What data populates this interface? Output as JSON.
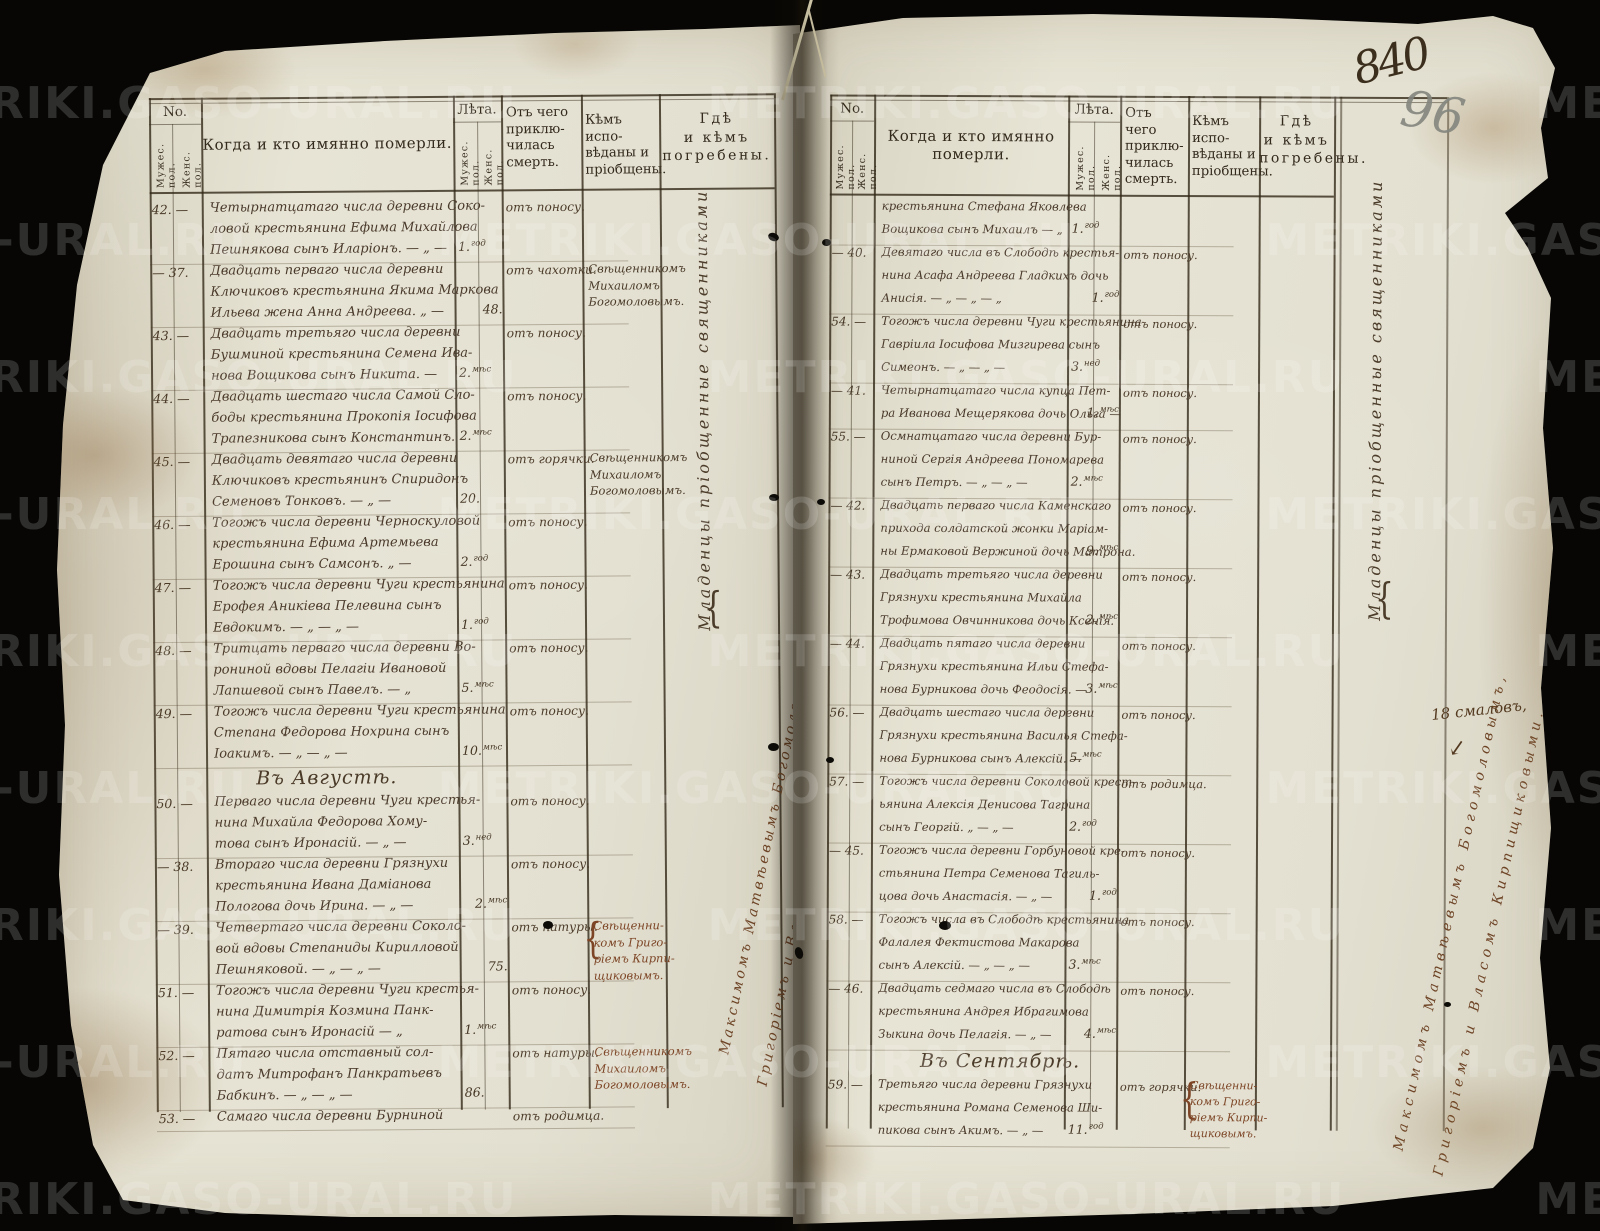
{
  "watermark": "METRIKI.GASO-URAL.RU",
  "annotations": {
    "folio_number_ink": "840",
    "folio_number_pencil": "96",
    "margin_note": "18 смаловъ,",
    "margin_arrow": "↙"
  },
  "column_headers": {
    "no": "No.",
    "age": "Лѣта.",
    "male": "Мужес. пол.",
    "female": "Женс. пол.",
    "when_who": "Когда и кто имянно померли.",
    "cause_lines": [
      "Отъ чего",
      "приклю-",
      "чилась",
      "смерть."
    ],
    "confessed_lines": [
      "Кѣмъ испо-",
      "вѣданы и",
      "пріобщены."
    ],
    "buried_lines": [
      "Гдѣ",
      "и кѣмъ",
      "погребены."
    ]
  },
  "left_page": {
    "entries": [
      {
        "no": "42.",
        "gender": "m",
        "lines": [
          "Четырнатцатаго числа деревни Соко-",
          "ловой крестьянина Ефима Михайлова",
          "Пешнякова сынъ Иларіонъ. — „ —"
        ],
        "age_value": "1.",
        "age_unit": "год",
        "cause": "отъ поносу."
      },
      {
        "no": "37.",
        "gender": "f",
        "lines": [
          "Двадцать перваго числа деревни",
          "Ключиковъ крестьянина Якима Маркова",
          "Ильева жена Анна Андреева. „ —"
        ],
        "age_value": "48.",
        "age_unit": "",
        "cause": "отъ чахотки.",
        "confessor_lines": [
          "Свѣщенникомъ",
          "Михаиломъ",
          "Богомоловымъ."
        ],
        "confessor_ink": "dark"
      },
      {
        "no": "43.",
        "gender": "m",
        "lines": [
          "Двадцать третьяго числа деревни",
          "Бушминой крестьянина Семена Ива-",
          "нова Вощикова сынъ Никита. —"
        ],
        "age_value": "2.",
        "age_unit": "мѣс",
        "cause": "отъ поносу."
      },
      {
        "no": "44.",
        "gender": "m",
        "lines": [
          "Двадцать шестаго числа Самой Сло-",
          "боды крестьянина Прокопія Іосифова",
          "Трапезникова сынъ Константинъ."
        ],
        "age_value": "2.",
        "age_unit": "мѣс",
        "cause": "отъ поносу."
      },
      {
        "no": "45.",
        "gender": "m",
        "lines": [
          "Двадцать девятаго числа деревни",
          "Ключиковъ крестьянинъ Спиридонъ",
          "Семеновъ Тонковъ. — „ —"
        ],
        "age_value": "20.",
        "age_unit": "",
        "cause": "отъ горячки.",
        "confessor_lines": [
          "Свѣщенникомъ",
          "Михаиломъ",
          "Богомоловымъ."
        ],
        "confessor_ink": "dark"
      },
      {
        "no": "46.",
        "gender": "m",
        "lines": [
          "Тогожъ числа деревни Черноскуловой",
          "крестьянина Ефима Артемьева",
          "Ерошина сынъ Самсонъ. „ —"
        ],
        "age_value": "2.",
        "age_unit": "год",
        "cause": "отъ поносу."
      },
      {
        "no": "47.",
        "gender": "m",
        "lines": [
          "Тогожъ числа деревни Чуги крестьянина",
          "Ерофея Аникіева Пелевина сынъ",
          "Евдокимъ. — „ — „ —"
        ],
        "age_value": "1.",
        "age_unit": "год",
        "cause": "отъ поносу."
      },
      {
        "no": "48.",
        "gender": "m",
        "lines": [
          "Тритцать перваго числа деревни Во-",
          "рониной вдовы Пелагіи Ивановой",
          "Лапшевой сынъ Павелъ. — „"
        ],
        "age_value": "5.",
        "age_unit": "мѣс",
        "cause": "отъ поносу."
      },
      {
        "no": "49.",
        "gender": "m",
        "lines": [
          "Тогожъ числа деревни Чуги крестьянина",
          "Степана Федорова Нохрина сынъ",
          "Іоакимъ. — „ — „ —"
        ],
        "age_value": "10.",
        "age_unit": "мѣс",
        "cause": "отъ поносу."
      },
      {
        "month_heading": "Въ Августѣ."
      },
      {
        "no": "50.",
        "gender": "m",
        "lines": [
          "Перваго числа деревни Чуги крестья-",
          "нина Михайла Федорова Хому-",
          "това сынъ Иронасій. — „ —"
        ],
        "age_value": "3.",
        "age_unit": "нед",
        "cause": "отъ поносу."
      },
      {
        "no": "38.",
        "gender": "f",
        "lines": [
          "Втораго числа деревни Грязнухи",
          "крестьянина Ивана Даміанова",
          "Пологова дочь Ирина. — „ —"
        ],
        "age_value": "2.",
        "age_unit": "мѣс",
        "cause": "отъ поносу."
      },
      {
        "no": "39.",
        "gender": "f",
        "lines": [
          "Четвертаго числа деревни Соколо-",
          "вой вдовы Степаниды Кирилловой",
          "Пешняковой. — „ — „ —"
        ],
        "age_value": "75.",
        "age_unit": "",
        "cause": "отъ натуры.",
        "confessor_lines": [
          "Свѣщенни-",
          "комъ Григо-",
          "ріемъ Кирпи-",
          "щиковымъ."
        ],
        "confessor_ink": "red",
        "brace": true
      },
      {
        "no": "51.",
        "gender": "m",
        "lines": [
          "Тогожъ числа деревни Чуги крестья-",
          "нина Димитрія Козмина Панк-",
          "ратова сынъ Иронасій — „"
        ],
        "age_value": "1.",
        "age_unit": "мѣс",
        "cause": "отъ поносу."
      },
      {
        "no": "52.",
        "gender": "m",
        "lines": [
          "Пятаго числа отставный сол-",
          "датъ Митрофанъ Панкратьевъ",
          "Бабкинъ. — „ — „ —"
        ],
        "age_value": "86.",
        "age_unit": "",
        "cause": "отъ натуры.",
        "confessor_lines": [
          "Свѣщенникомъ",
          "Михаиломъ",
          "Богомоловымъ."
        ],
        "confessor_ink": "red"
      },
      {
        "no": "53.",
        "gender": "m",
        "lines": [
          "Самаго числа деревни Бурниной"
        ],
        "cause": "отъ родимца."
      }
    ],
    "vertical_note": {
      "text": "Младенцы пріобщенные священниками",
      "names": [
        "Максимомъ Матвѣевымъ Богомоловымъ,",
        "Григоріемъ и Власомъ Кирпищиковыми."
      ]
    }
  },
  "right_page": {
    "entries": [
      {
        "no": "",
        "gender": "m",
        "lines": [
          "крестьянина Стефана Яковлева",
          "Вощикова сынъ Михаилъ — „"
        ],
        "age_value": "1.",
        "age_unit": "год"
      },
      {
        "no": "40.",
        "gender": "f",
        "lines": [
          "Девятаго числа въ Слободѣ крестья-",
          "нина Асафа Андреева Гладкихъ дочь",
          "Анисія. — „ — „ — „"
        ],
        "age_value": "1.",
        "age_unit": "год",
        "cause": "отъ поносу."
      },
      {
        "no": "54.",
        "gender": "m",
        "lines": [
          "Тогожъ числа деревни Чуги крестьянина",
          "Гавріила Іосифова Мизгирева сынъ",
          "Симеонъ. — „ — „ —"
        ],
        "age_value": "3.",
        "age_unit": "нед",
        "cause": "отъ поносу."
      },
      {
        "no": "41.",
        "gender": "f",
        "lines": [
          "Четырнатцатаго числа купца Пет-",
          "ра Иванова Мещерякова дочь Ольга —"
        ],
        "age_value": "1.",
        "age_unit": "мѣс",
        "cause": "отъ поносу."
      },
      {
        "no": "55.",
        "gender": "m",
        "lines": [
          "Осмнатцатаго числа деревни Бур-",
          "ниной Сергія Андреева Пономарева",
          "сынъ Петръ. — „ — „ —"
        ],
        "age_value": "2.",
        "age_unit": "мѣс",
        "cause": "отъ поносу."
      },
      {
        "no": "42.",
        "gender": "f",
        "lines": [
          "Двадцать перваго числа Каменскаго",
          "прихода солдатской жонки Маріам-",
          "ны Ермаковой Вержиной дочь Матрона."
        ],
        "age_value": "9.",
        "age_unit": "мѣс",
        "cause": "отъ поносу."
      },
      {
        "no": "43.",
        "gender": "f",
        "lines": [
          "Двадцать третьяго числа деревни",
          "Грязнухи крестьянина Михайла",
          "Трофимова Овчинникова дочь Ксенія."
        ],
        "age_value": "2.",
        "age_unit": "мѣс",
        "cause": "отъ поносу."
      },
      {
        "no": "44.",
        "gender": "f",
        "lines": [
          "Двадцать пятаго числа деревни",
          "Грязнухи крестьянина Ильи Стефа-",
          "нова Бурникова дочь Феодосія. —"
        ],
        "age_value": "3.",
        "age_unit": "мѣс",
        "cause": "отъ поносу."
      },
      {
        "no": "56.",
        "gender": "m",
        "lines": [
          "Двадцать шестаго числа деревни",
          "Грязнухи крестьянина Василья Стефа-",
          "нова Бурникова сынъ Алексій. —"
        ],
        "age_value": "5.",
        "age_unit": "мѣс",
        "cause": "отъ поносу."
      },
      {
        "no": "57.",
        "gender": "m",
        "lines": [
          "Тогожъ числа деревни Соколовой крест-",
          "ьянина Алексія Денисова Тагрина",
          "сынъ Георгій. „ — „ —"
        ],
        "age_value": "2.",
        "age_unit": "год",
        "cause": "отъ родимца."
      },
      {
        "no": "45.",
        "gender": "f",
        "lines": [
          "Тогожъ числа деревни Горбуновой кре-",
          "стьянина Петра Семенова Тагиль-",
          "цова дочь Анастасія. — „ —"
        ],
        "age_value": "1.",
        "age_unit": "год",
        "cause": "отъ поносу."
      },
      {
        "no": "58.",
        "gender": "m",
        "lines": [
          "Тогожъ числа въ Слободѣ крестьянина",
          "Фалалея Фектистова Макарова",
          "сынъ Алексій. — „ — „ —"
        ],
        "age_value": "3.",
        "age_unit": "мѣс",
        "cause": "отъ поносу."
      },
      {
        "no": "46.",
        "gender": "f",
        "lines": [
          "Двадцать седмаго числа въ Слободѣ",
          "крестьянина Андрея Ибрагимова",
          "Зыкина дочь Пелагія. — „ —"
        ],
        "age_value": "4.",
        "age_unit": "мѣс",
        "cause": "отъ поносу."
      },
      {
        "month_heading": "Въ Сентябрѣ."
      },
      {
        "no": "59.",
        "gender": "m",
        "lines": [
          "Третьяго числа деревни Грязнухи",
          "крестьянина Романа Семенова Ши-",
          "пикова сынъ Акимъ. — „ —"
        ],
        "age_value": "11.",
        "age_unit": "год",
        "cause": "отъ горячки.",
        "confessor_lines": [
          "Свѣщенни-",
          "комъ Григо-",
          "ріемъ Кирпи-",
          "щиковымъ."
        ],
        "confessor_ink": "red",
        "brace": true
      }
    ],
    "vertical_note": {
      "text": "Младенцы пріобщенные священниками",
      "names": [
        "Максимомъ Матвѣевымъ Богомоловымъ,",
        "Григоріемъ и Власомъ Кирпищиковыми."
      ]
    }
  }
}
